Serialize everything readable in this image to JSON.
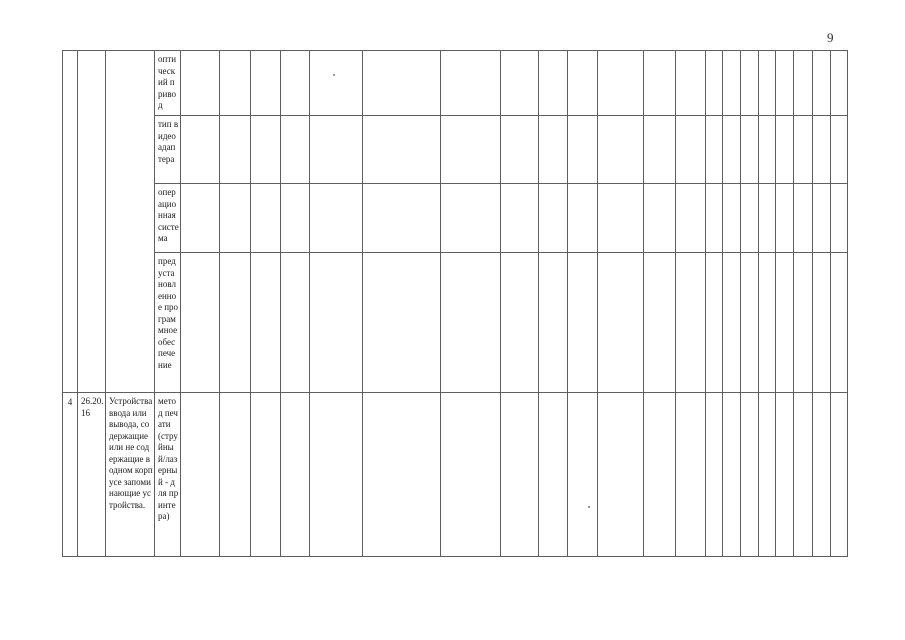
{
  "page": {
    "number": "9"
  },
  "table": {
    "characteristic_rows": [
      {
        "label": "оптический привод"
      },
      {
        "label": "тип видеоадаптера"
      },
      {
        "label": "операционная система"
      },
      {
        "label": "предустановленное программное обеспечение"
      }
    ],
    "data_row": {
      "index": "4",
      "code": "26.20.16",
      "description": "Устройства ввода или вывода, содержащие или не содержащие в одном корпусе запоминающие устройства.",
      "characteristic": "метод печати (струйный/лазерный - для принтера)"
    },
    "empty_data_columns": 21,
    "rows_total": 5
  }
}
